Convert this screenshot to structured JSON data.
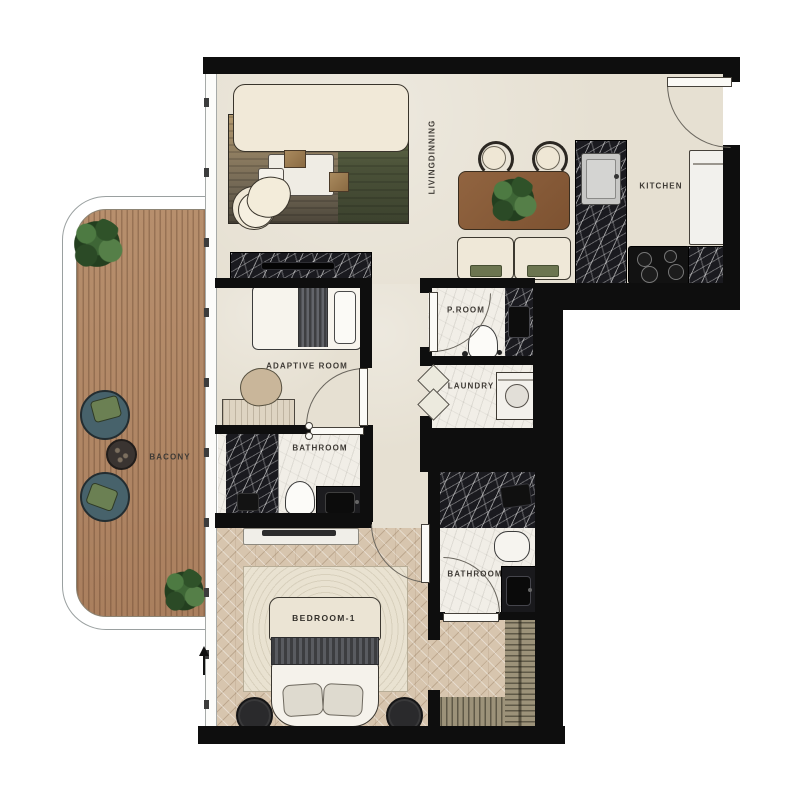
{
  "plan": {
    "title": "apartment floor plan",
    "labels": {
      "living": "LIVINGDINNING",
      "kitchen": "KITCHEN",
      "adaptive": "ADAPTIVE ROOM",
      "proom": "P.ROOM",
      "laundry": "LAUNDRY",
      "bathroom1": "BATHROOM",
      "bathroom2": "BATHROOM",
      "bedroom1": "BEDROOM-1",
      "balcony": "BACONY"
    },
    "colors": {
      "wall": "#0e0e0e",
      "floor": "#e6e0d2",
      "deck_wood": "#b18a68",
      "herringbone_wood": "#d7c5ae",
      "marble_dark": "#1a1a1f",
      "marble_light": "#f1eee7",
      "olive_accent": "#6c7550",
      "teal_cushion": "#47626b",
      "dining_wood": "#8a5c3e",
      "cream_upholstery": "#efe8d7"
    }
  }
}
